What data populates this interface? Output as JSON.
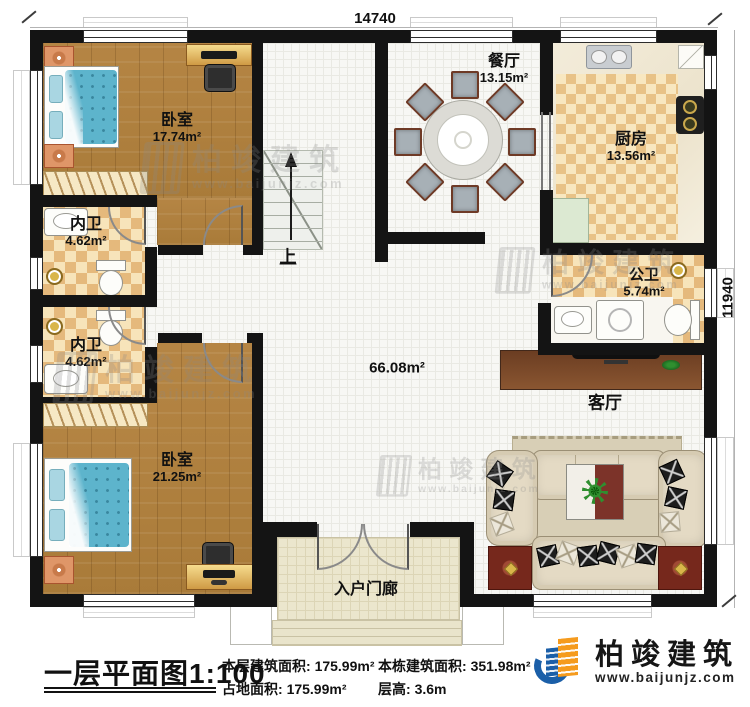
{
  "plan": {
    "dimension_top": "14740",
    "dimension_right": "11940",
    "stairs_up_label": "上",
    "hall_area": "66.08m²",
    "rooms": {
      "bedroom1": {
        "name": "卧室",
        "area": "17.74m²"
      },
      "bathroom1": {
        "name": "内卫",
        "area": "4.62m²"
      },
      "bathroom2": {
        "name": "内卫",
        "area": "4.62m²"
      },
      "bedroom2": {
        "name": "卧室",
        "area": "21.25m²"
      },
      "dining": {
        "name": "餐厅",
        "area": "13.15m²"
      },
      "kitchen": {
        "name": "厨房",
        "area": "13.56m²"
      },
      "public_bathroom": {
        "name": "公卫",
        "area": "5.74m²"
      },
      "living": {
        "name": "客厅"
      },
      "porch": {
        "name": "入户门廊"
      }
    }
  },
  "watermark": {
    "brand": "柏竣建筑",
    "website": "www.baijunjz.com"
  },
  "footer": {
    "plan_title": "一层平面图1:100",
    "stats": {
      "floor_area_label": "本层建筑面积:",
      "floor_area_value": "175.99m²",
      "footprint_label": "占地面积:",
      "footprint_value": "175.99m²",
      "building_area_label": "本栋建筑面积:",
      "building_area_value": "351.98m²",
      "floor_height_label": "层高:",
      "floor_height_value": "3.6m"
    },
    "logo": {
      "brand": "柏竣建筑",
      "website": "www.baijunjz.com"
    }
  }
}
